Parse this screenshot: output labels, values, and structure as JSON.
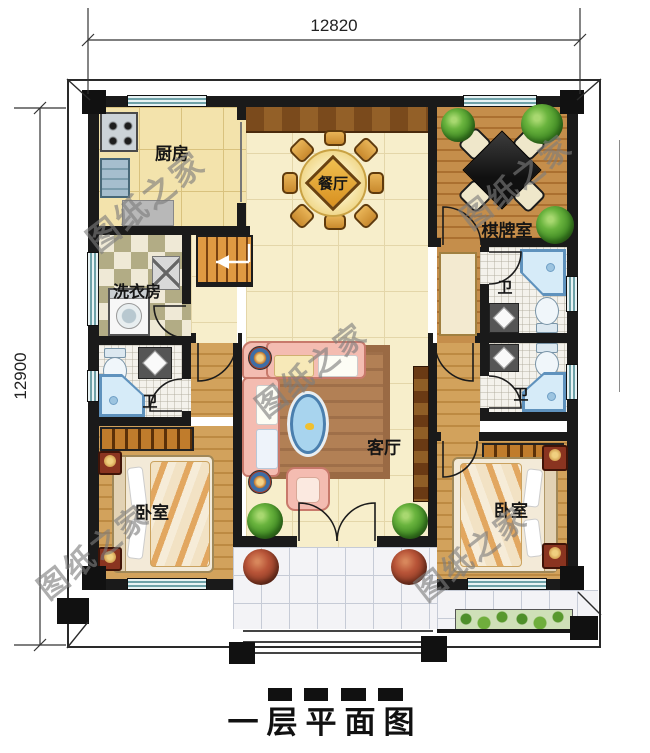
{
  "title": "一层平面图",
  "dimensions": {
    "top_width": "12820",
    "left_height": "12900"
  },
  "watermark": {
    "text": "图纸之家"
  },
  "rooms": {
    "kitchen": {
      "label": "厨房"
    },
    "dining": {
      "label": "餐厅"
    },
    "mahjong_room": {
      "label": "棋牌室"
    },
    "laundry": {
      "label": "洗衣房"
    },
    "bath_left": {
      "label": "卫"
    },
    "bath_right_top": {
      "label": "卫"
    },
    "bath_right_bottom": {
      "label": "卫"
    },
    "living": {
      "label": "客厅"
    },
    "bedroom_left": {
      "label": "卧室"
    },
    "bedroom_right": {
      "label": "卧室"
    }
  },
  "colors": {
    "wall": "#1a1a1a",
    "floor_tile": "#f7eecb",
    "wood_floor": "#c58e4b",
    "window_glass": "#cfe4e7",
    "stairs": "#d8903a",
    "sofa": "#f4bcb1",
    "plant": "#55a22e",
    "water_fixture": "#cfe6f4"
  }
}
